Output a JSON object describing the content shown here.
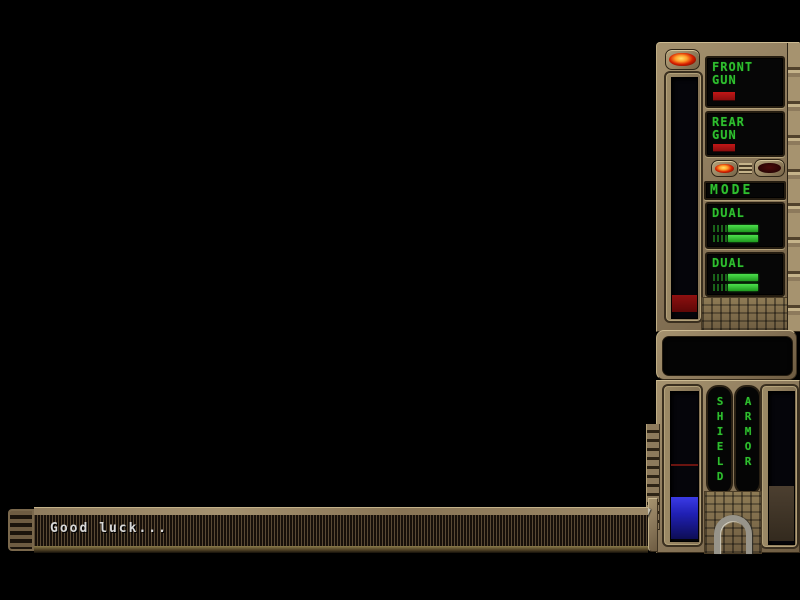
{
  "colors": {
    "lcd_green": "#2fbe2f",
    "warning_red": "#a31212",
    "shield_blue": "#2727d4",
    "armor_brown": "#44382a",
    "bronze_metal": "#8d7a5c",
    "display_black": "#060606"
  },
  "weapon_panel": {
    "power_light_state": "on",
    "energy_bar": {
      "fill_percent": "7%",
      "fill_color": "#7c0b0b"
    },
    "front_gun": {
      "line1": "FRONT",
      "line2": "GUN"
    },
    "rear_gun": {
      "line1": "REAR",
      "line2": "GUN"
    },
    "mode": {
      "label": "MODE",
      "left_light_state": "on",
      "right_light_state": "off"
    },
    "dual_top": {
      "label": "DUAL"
    },
    "dual_bottom": {
      "label": "DUAL"
    }
  },
  "status_panel": {
    "shield": {
      "label": "SHIELD",
      "fill_percent": "28%"
    },
    "armor": {
      "label": "ARMOR",
      "fill_percent": "36%"
    }
  },
  "message_bar": {
    "text": "Good luck..."
  }
}
